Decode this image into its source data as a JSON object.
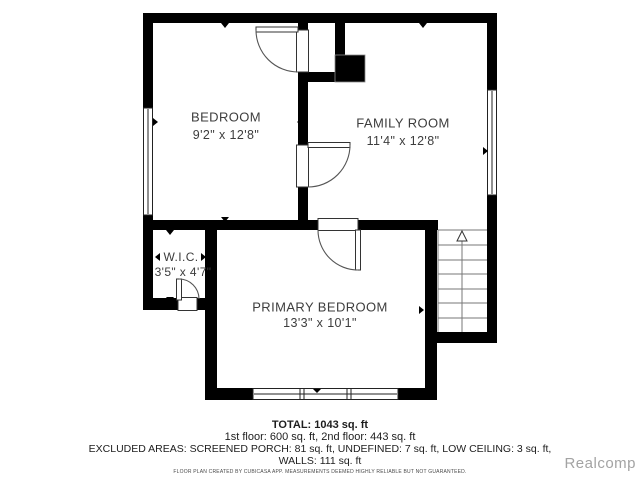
{
  "floor_plan": {
    "rooms": [
      {
        "name": "BEDROOM",
        "dimensions": "9'2\" x 12'8\""
      },
      {
        "name": "FAMILY ROOM",
        "dimensions": "11'4\" x 12'8\""
      },
      {
        "name": "W.I.C.",
        "dimensions": "3'5\" x 4'7\""
      },
      {
        "name": "PRIMARY BEDROOM",
        "dimensions": "13'3\" x 10'1\""
      }
    ],
    "stairs": {
      "direction": "up",
      "icon": "stairs-up-arrow-icon"
    },
    "features": [
      "chimney-block",
      "windows",
      "door-swing-arcs"
    ]
  },
  "summary": {
    "total": "TOTAL: 1043 sq. ft",
    "floors": "1st floor: 600 sq. ft, 2nd floor: 443 sq. ft",
    "excluded_areas": "EXCLUDED AREAS: SCREENED PORCH: 81 sq. ft, UNDEFINED: 7 sq. ft, LOW CEILING: 3 sq. ft,",
    "walls": "WALLS: 111 sq. ft",
    "disclaimer": "FLOOR PLAN CREATED BY CUBICASA APP. MEASUREMENTS DEEMED HIGHLY RELIABLE BUT NOT GUARANTEED."
  },
  "watermark": "Realcomp",
  "colors": {
    "wall": "#000000",
    "room_text": "#3d3d3d",
    "footer_text": "#1d1d1d",
    "watermark_text": "#a3a3a3",
    "background": "#ffffff"
  }
}
